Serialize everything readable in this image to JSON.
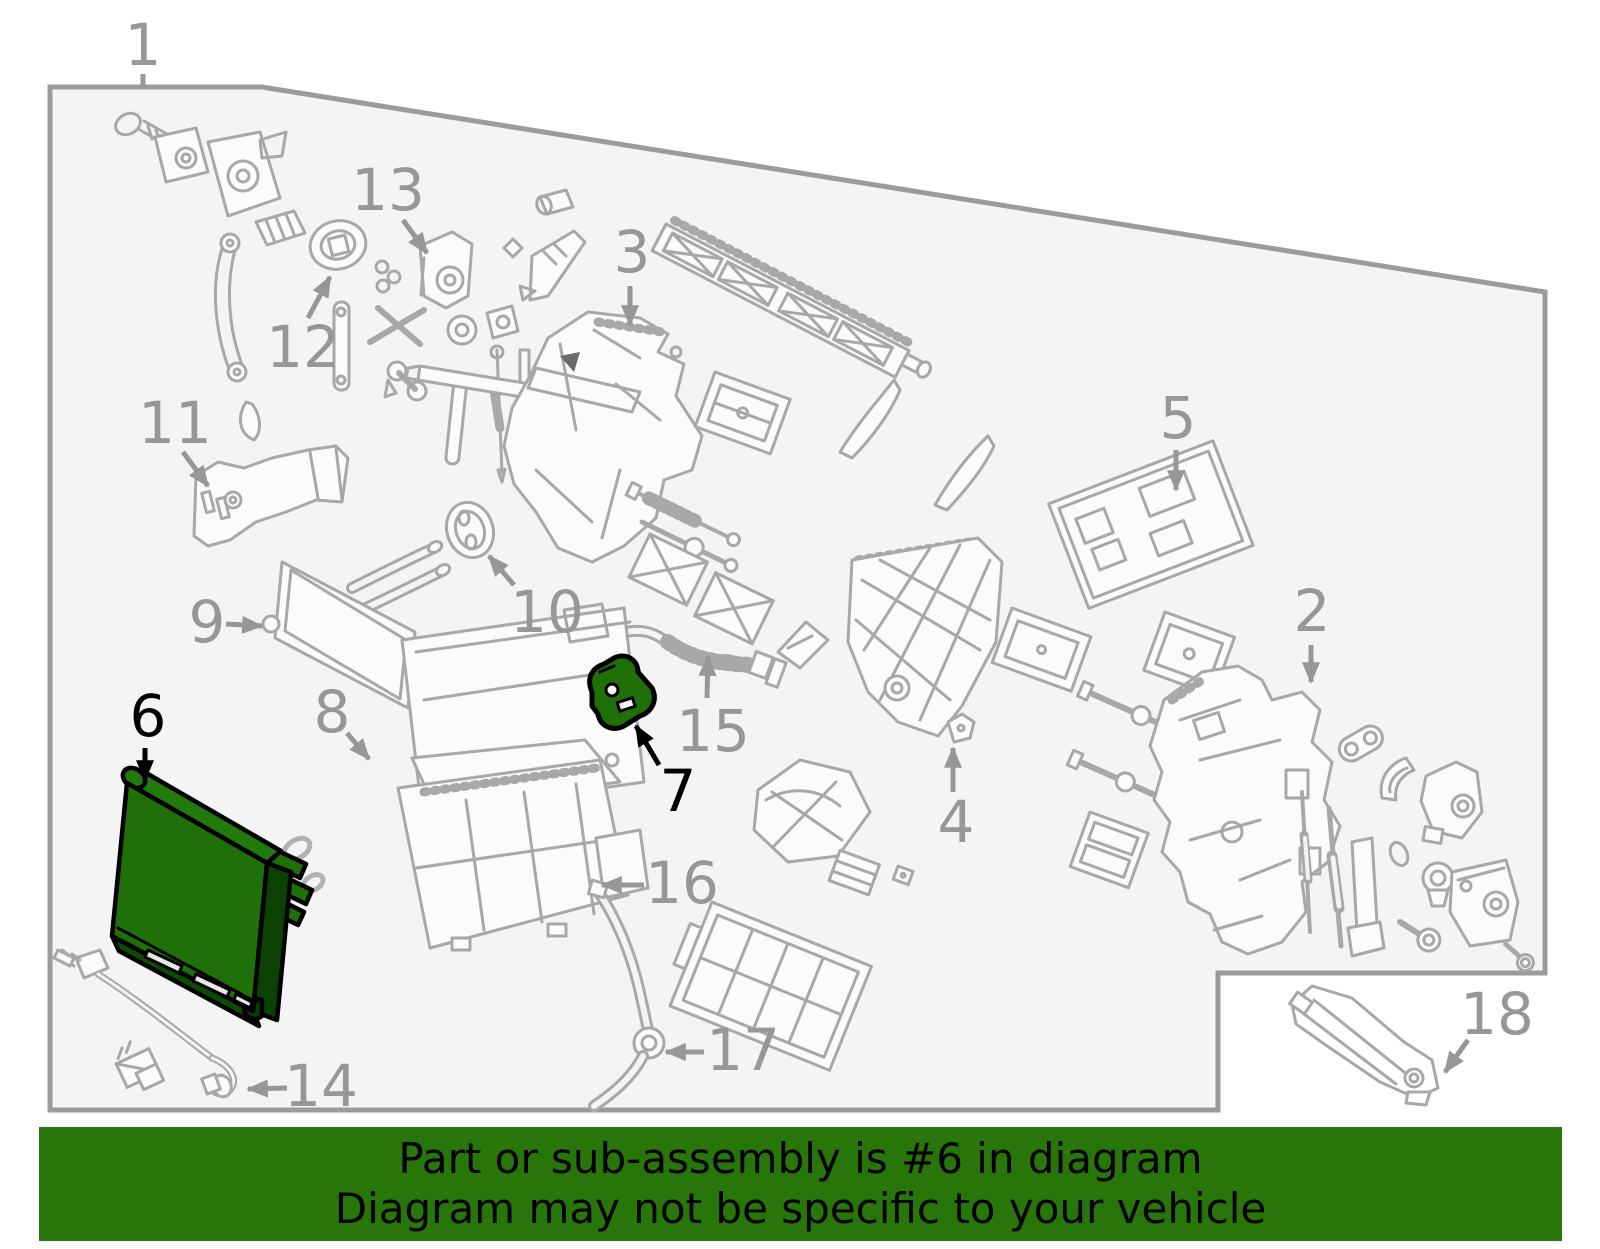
{
  "page": {
    "background": "#ffffff"
  },
  "diagram": {
    "background": "#f4f4f4",
    "border_color": "#9b9b9b",
    "line_color": "#a8a8a8",
    "callout_color": "#979797",
    "highlight_callout_color": "#000000",
    "highlight_color": "#1f7008",
    "highlighted_parts": [
      "6",
      "7"
    ],
    "callouts": [
      {
        "label": "1",
        "x": 143,
        "y": 45,
        "highlighted": false,
        "arrow": {
          "x1": 143,
          "y1": 74,
          "x2": 143,
          "y2": 88,
          "head": false
        }
      },
      {
        "label": "2",
        "x": 1312,
        "y": 611,
        "highlighted": false,
        "arrow": {
          "x1": 1311,
          "y1": 645,
          "x2": 1311,
          "y2": 682,
          "head": true
        }
      },
      {
        "label": "3",
        "x": 632,
        "y": 252,
        "highlighted": false,
        "arrow": {
          "x1": 630,
          "y1": 286,
          "x2": 630,
          "y2": 325,
          "head": true
        }
      },
      {
        "label": "4",
        "x": 956,
        "y": 822,
        "highlighted": false,
        "arrow": {
          "x1": 953,
          "y1": 792,
          "x2": 953,
          "y2": 748,
          "head": true
        }
      },
      {
        "label": "5",
        "x": 1178,
        "y": 418,
        "highlighted": false,
        "arrow": {
          "x1": 1176,
          "y1": 450,
          "x2": 1176,
          "y2": 490,
          "head": true
        }
      },
      {
        "label": "6",
        "x": 148,
        "y": 716,
        "highlighted": true,
        "arrow": {
          "x1": 145,
          "y1": 748,
          "x2": 145,
          "y2": 780,
          "head": true
        }
      },
      {
        "label": "7",
        "x": 678,
        "y": 791,
        "highlighted": true,
        "arrow": {
          "x1": 659,
          "y1": 765,
          "x2": 636,
          "y2": 726,
          "head": true
        }
      },
      {
        "label": "8",
        "x": 332,
        "y": 712,
        "highlighted": false,
        "arrow": {
          "x1": 347,
          "y1": 733,
          "x2": 369,
          "y2": 759,
          "head": true
        }
      },
      {
        "label": "9",
        "x": 207,
        "y": 622,
        "highlighted": false,
        "arrow": {
          "x1": 226,
          "y1": 624,
          "x2": 262,
          "y2": 626,
          "head": true
        }
      },
      {
        "label": "10",
        "x": 547,
        "y": 612,
        "highlighted": false,
        "arrow": {
          "x1": 514,
          "y1": 585,
          "x2": 489,
          "y2": 556,
          "head": true
        }
      },
      {
        "label": "11",
        "x": 175,
        "y": 423,
        "highlighted": false,
        "arrow": {
          "x1": 183,
          "y1": 452,
          "x2": 208,
          "y2": 486,
          "head": true
        }
      },
      {
        "label": "12",
        "x": 303,
        "y": 347,
        "highlighted": false,
        "arrow": {
          "x1": 308,
          "y1": 318,
          "x2": 330,
          "y2": 277,
          "head": true
        }
      },
      {
        "label": "13",
        "x": 388,
        "y": 190,
        "highlighted": false,
        "arrow": {
          "x1": 403,
          "y1": 220,
          "x2": 427,
          "y2": 253,
          "head": true
        }
      },
      {
        "label": "14",
        "x": 321,
        "y": 1086,
        "highlighted": false,
        "arrow": {
          "x1": 287,
          "y1": 1088,
          "x2": 248,
          "y2": 1089,
          "head": true
        }
      },
      {
        "label": "15",
        "x": 713,
        "y": 731,
        "highlighted": false,
        "arrow": {
          "x1": 707,
          "y1": 698,
          "x2": 708,
          "y2": 656,
          "head": true
        }
      },
      {
        "label": "16",
        "x": 682,
        "y": 883,
        "highlighted": false,
        "arrow": {
          "x1": 644,
          "y1": 885,
          "x2": 602,
          "y2": 885,
          "head": true
        }
      },
      {
        "label": "17",
        "x": 743,
        "y": 1050,
        "highlighted": false,
        "arrow": {
          "x1": 704,
          "y1": 1052,
          "x2": 666,
          "y2": 1052,
          "head": true
        }
      },
      {
        "label": "18",
        "x": 1497,
        "y": 1014,
        "highlighted": false,
        "arrow": {
          "x1": 1468,
          "y1": 1040,
          "x2": 1445,
          "y2": 1072,
          "head": true
        }
      }
    ]
  },
  "banner": {
    "background": "#287609",
    "text_color": "#000000",
    "line1": "Part or sub-assembly is #6 in diagram",
    "line2": "Diagram may not be specific to your vehicle"
  }
}
